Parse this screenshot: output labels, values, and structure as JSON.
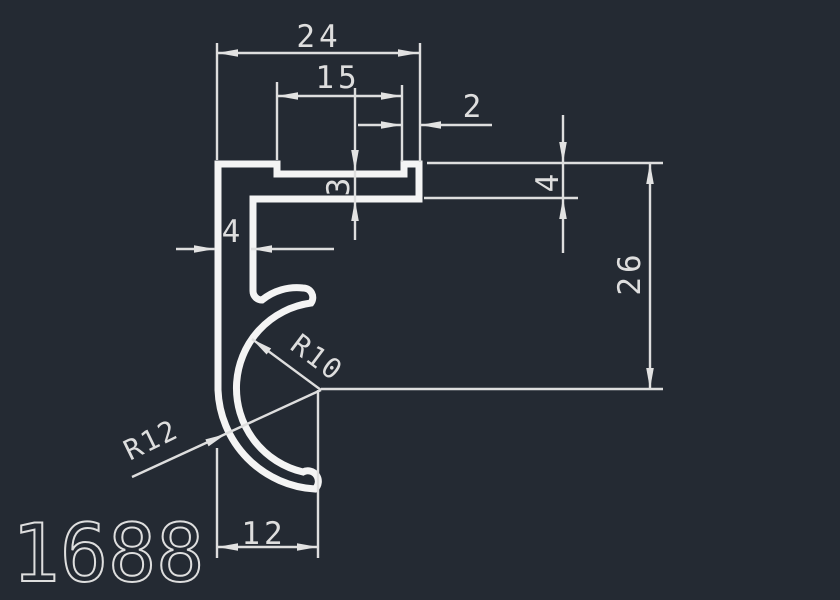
{
  "drawing": {
    "part_number": "1688",
    "colors": {
      "background": "#242a33",
      "geometry": "#f4f4f4",
      "annotation": "#dedede"
    },
    "dimensions": {
      "overall_width": "24",
      "recess_width": "15",
      "lip_width": "2",
      "recess_thickness": "3",
      "leg_width": "4",
      "flange_thickness": "4",
      "center_height": "26",
      "groove_offset": "12"
    },
    "radii": {
      "inner": "R10",
      "outer": "R12"
    }
  }
}
